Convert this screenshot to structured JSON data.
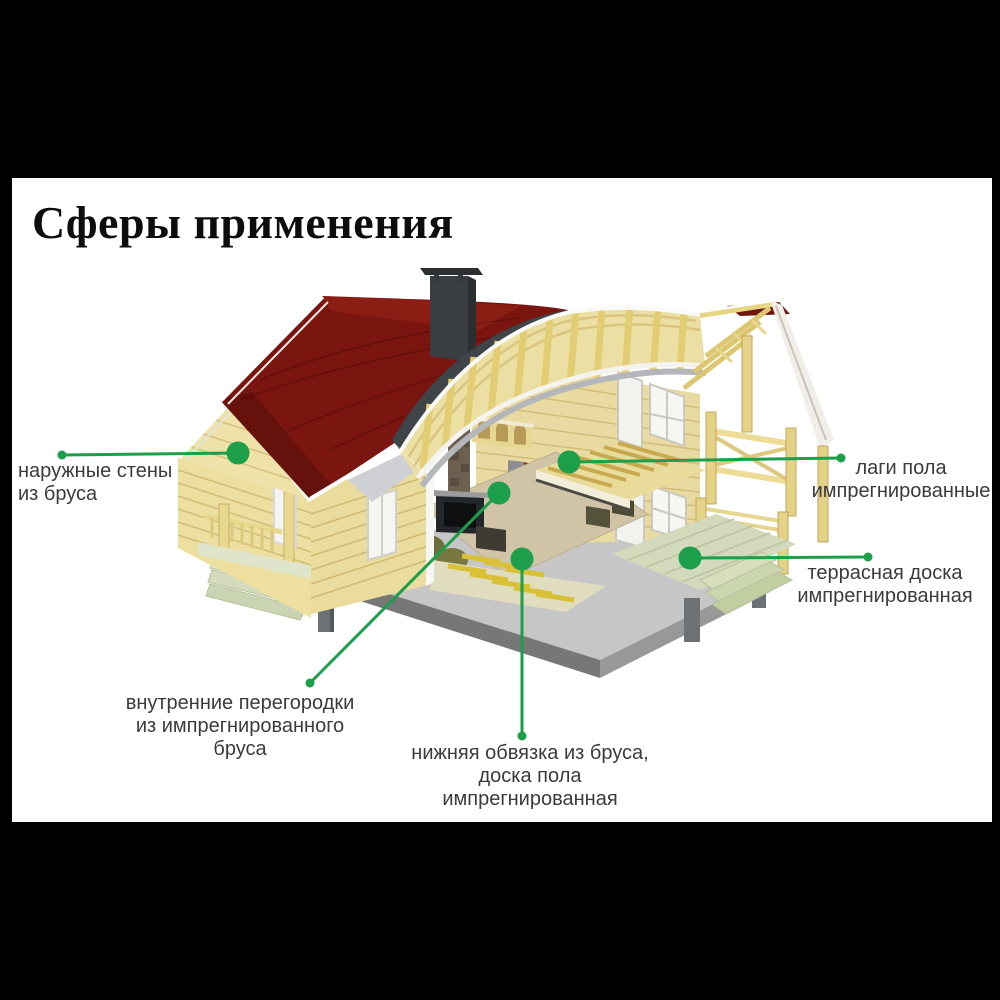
{
  "title": {
    "text": "Сферы применения"
  },
  "colors": {
    "letterbox": "#000000",
    "canvas": "#ffffff",
    "title": "#0d0d0d",
    "label_text": "#3b3b3b",
    "annotation_green": "#1d9e4b",
    "roof_red": "#7a150f",
    "wood_light": "#ecdfa3",
    "terrace_green": "#d2dabb",
    "foundation_gray": "#8c8c8c",
    "interior_red": "#a03224"
  },
  "diagram": {
    "labels": [
      {
        "id": "outer-walls",
        "lines": [
          "наружные стены",
          "из бруса"
        ]
      },
      {
        "id": "floor-joists",
        "lines": [
          "лаги пола",
          "импрегнированные"
        ]
      },
      {
        "id": "terrace",
        "lines": [
          "террасная доска",
          "импрегнированная"
        ]
      },
      {
        "id": "partitions",
        "lines": [
          "внутренние перегородки",
          "из импрегнированного",
          "бруса"
        ]
      },
      {
        "id": "bottom-frame",
        "lines": [
          "нижняя обвязка из бруса,",
          "доска пола",
          "импрегнированная"
        ]
      }
    ]
  }
}
